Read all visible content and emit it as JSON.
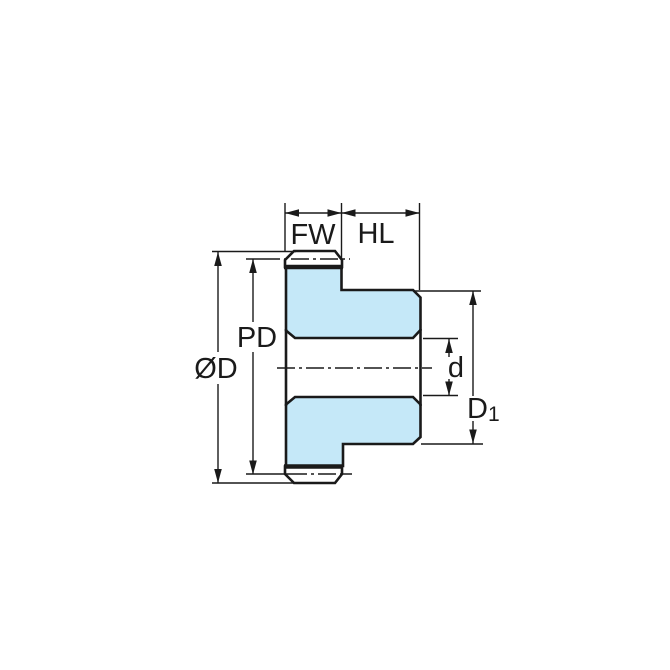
{
  "drawing": {
    "title": "Gear cross-section dimension diagram",
    "labels": {
      "face_width": "FW",
      "hub_length": "HL",
      "pitch_diameter": "PD",
      "outside_diameter": "ØD",
      "bore_diameter": "d",
      "hub_diameter_base": "D",
      "hub_diameter_sub": "1"
    },
    "colors": {
      "part_fill": "#c5e8f8",
      "line": "#1a1a1a",
      "background": "#ffffff"
    }
  }
}
